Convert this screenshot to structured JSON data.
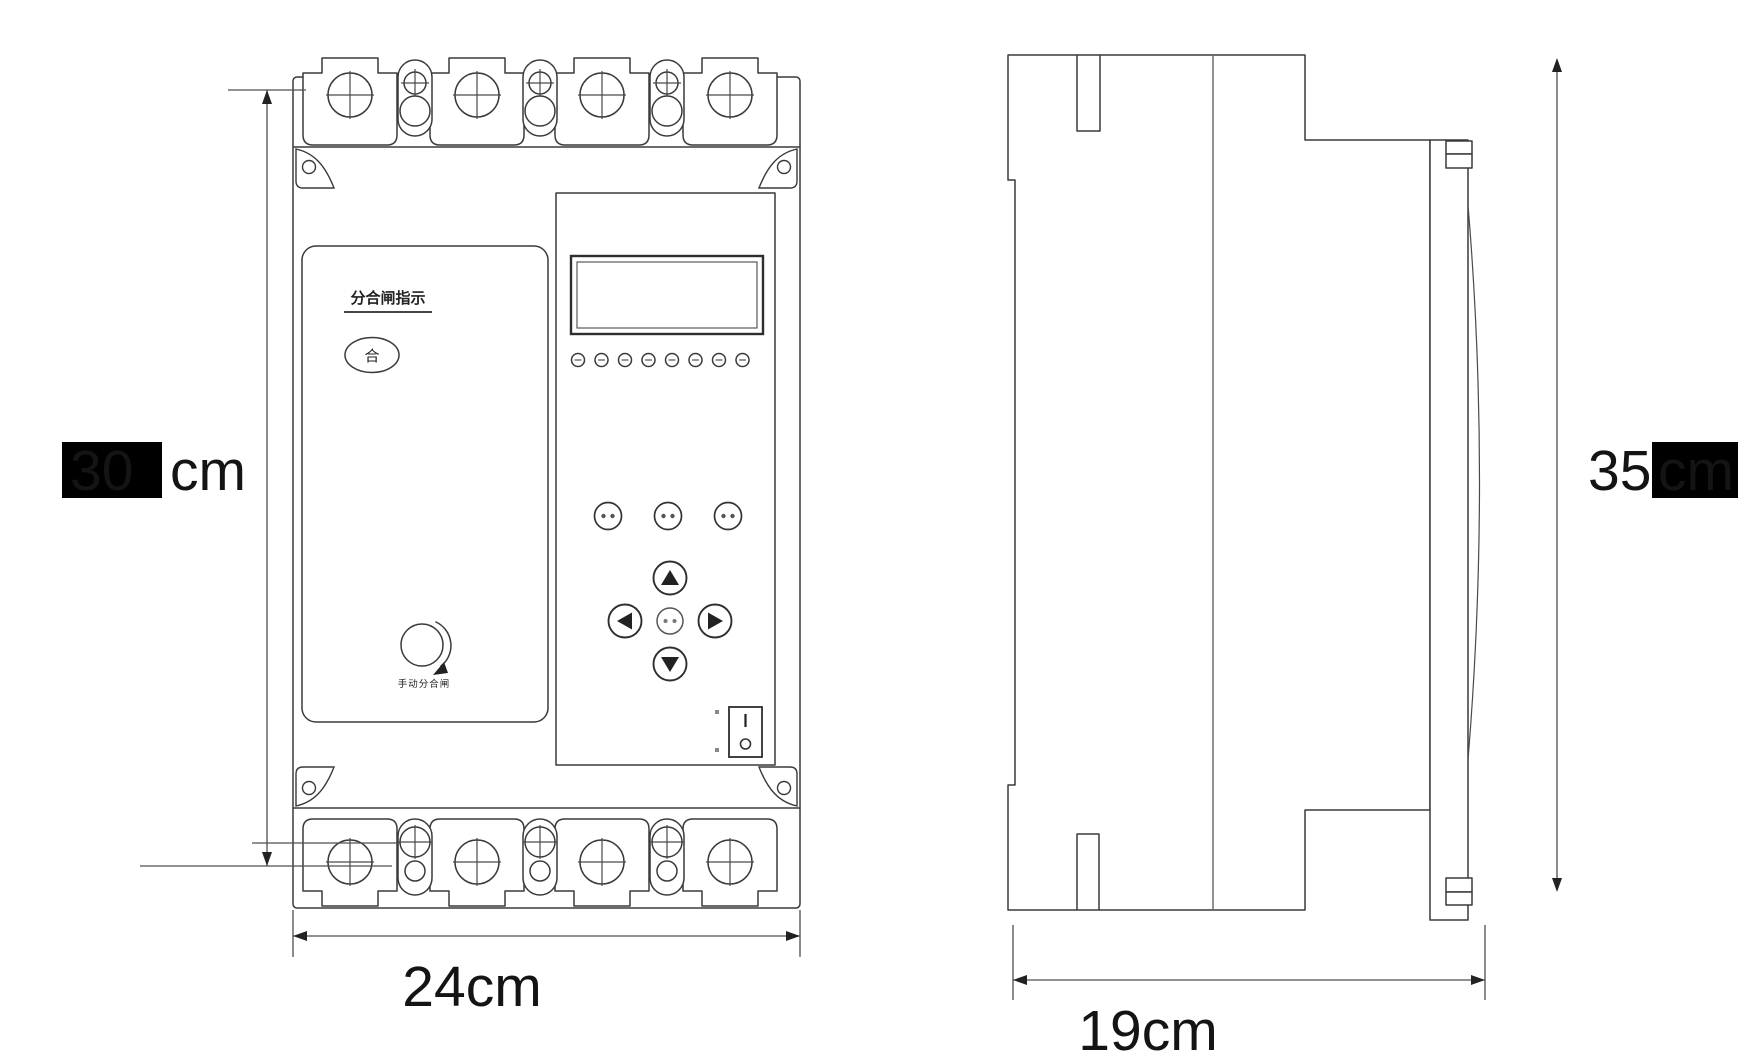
{
  "front_view": {
    "indicator_panel": {
      "title": "分合闸指示",
      "close_symbol": "合",
      "knob_label": "手动分合闸"
    },
    "control_panel": {
      "led_count": 8,
      "function_button_count": 3,
      "switch_on_symbol": "|",
      "switch_off_symbol": "O"
    }
  },
  "dimensions": {
    "front_height_boxed": "30",
    "front_height_visible": "cm",
    "front_width": "24cm",
    "side_height_visible": "35",
    "side_height_boxed": "cm",
    "side_depth": "19cm"
  }
}
